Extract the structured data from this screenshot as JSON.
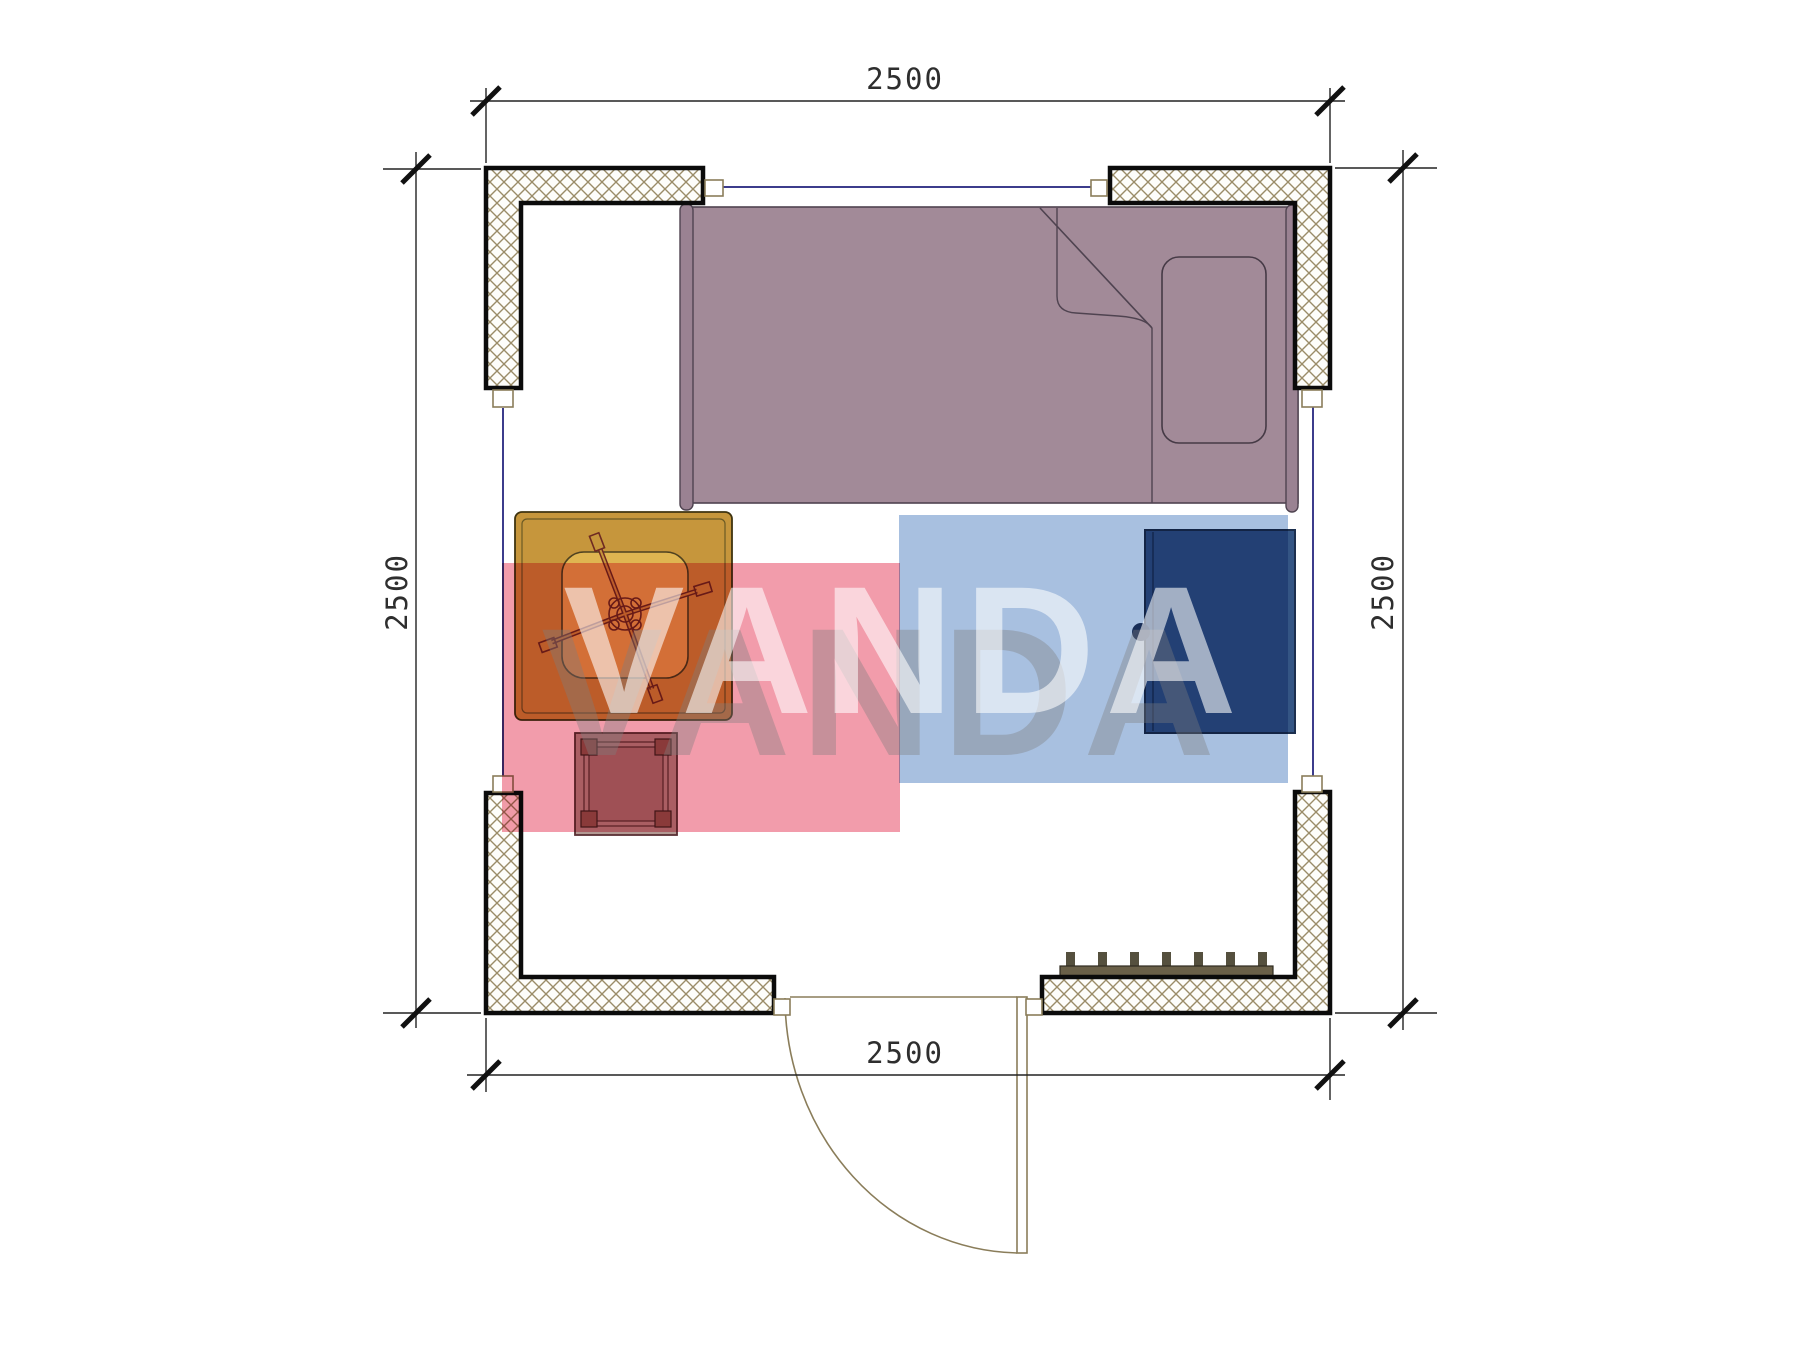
{
  "plan": {
    "dimension_labels": {
      "top": "2500",
      "bottom": "2500",
      "left": "2500",
      "right": "2500"
    },
    "watermark": {
      "text": "VANDA",
      "pink_block_color": "#f29cab",
      "blue_block_color": "#a8c0e0"
    },
    "furniture_items": [
      "bed",
      "pillow",
      "desk",
      "office-chair",
      "stool",
      "wardrobe",
      "heater",
      "door"
    ],
    "colors": {
      "bed": "#a28a98",
      "bed_rail": "#9a8292",
      "desk": "#c6963c",
      "desk_pad": "#dfb551",
      "stool": "#b39993",
      "stool_post": "#915e56",
      "wardrobe": "#345584",
      "heater": "#6a6048",
      "heater_fin": "#55503e",
      "wall_hatch": "#9a8c68",
      "window_line": "#3c3c8c",
      "door_line": "#8a7d5a",
      "pink_block": "#f29cab",
      "blue_block": "#a8c0e0"
    }
  }
}
